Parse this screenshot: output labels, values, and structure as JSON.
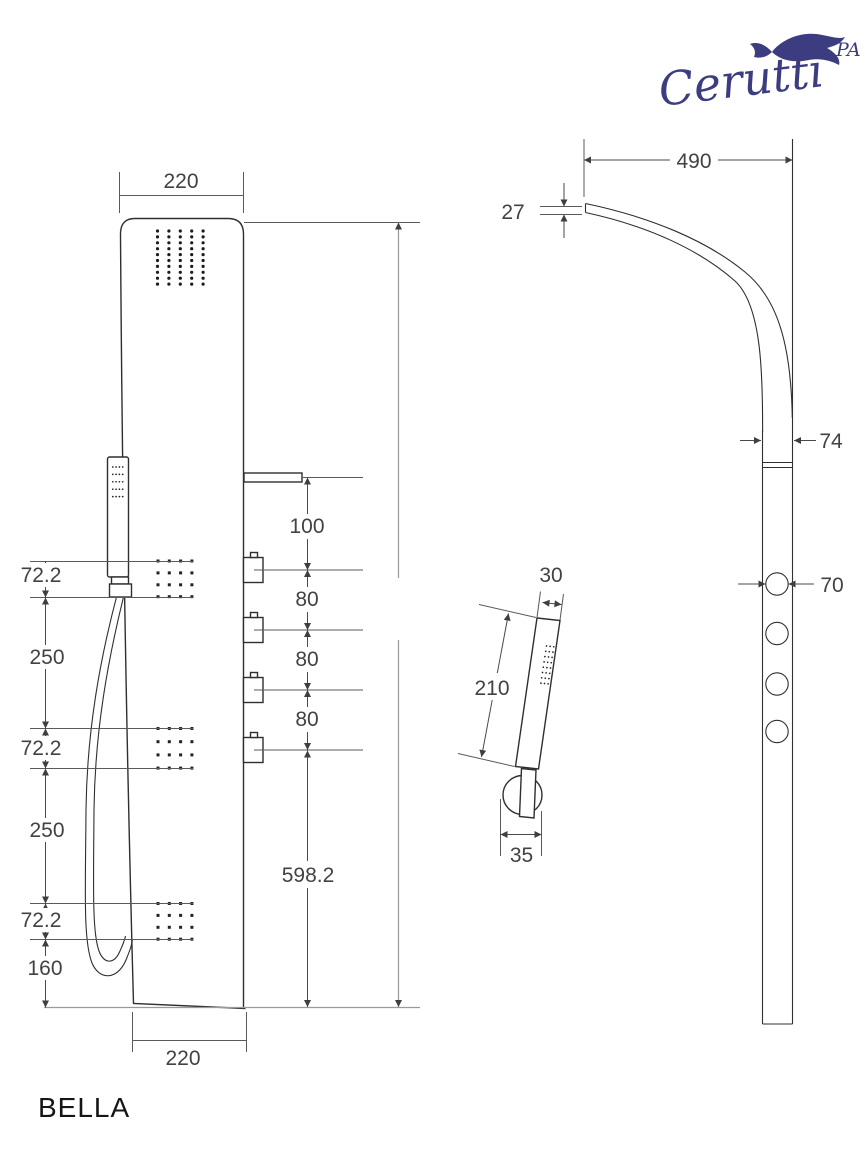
{
  "brand": {
    "name": "Cerutti",
    "suffix": "PA",
    "color": "#3c3c80"
  },
  "model": {
    "name": "BELLA"
  },
  "views": {
    "front": {
      "dim_top_width": "220",
      "dim_bottom_width": "220",
      "dim_jet1_height": "72.2",
      "dim_span1": "250",
      "dim_jet2_height": "72.2",
      "dim_span2": "250",
      "dim_jet3_height": "72.2",
      "dim_bottom_offset": "160",
      "dim_spout_to_knob": "100",
      "dim_knob_gap1": "80",
      "dim_knob_gap2": "80",
      "dim_knob_gap3": "80",
      "dim_lower_section": "598.2"
    },
    "side": {
      "dim_head_reach": "490",
      "dim_head_tip_thickness": "27",
      "dim_panel_depth": "74",
      "dim_knob_diameter": "70"
    },
    "hand_shower": {
      "dim_width": "30",
      "dim_length": "210",
      "dim_mount_width": "35"
    }
  }
}
